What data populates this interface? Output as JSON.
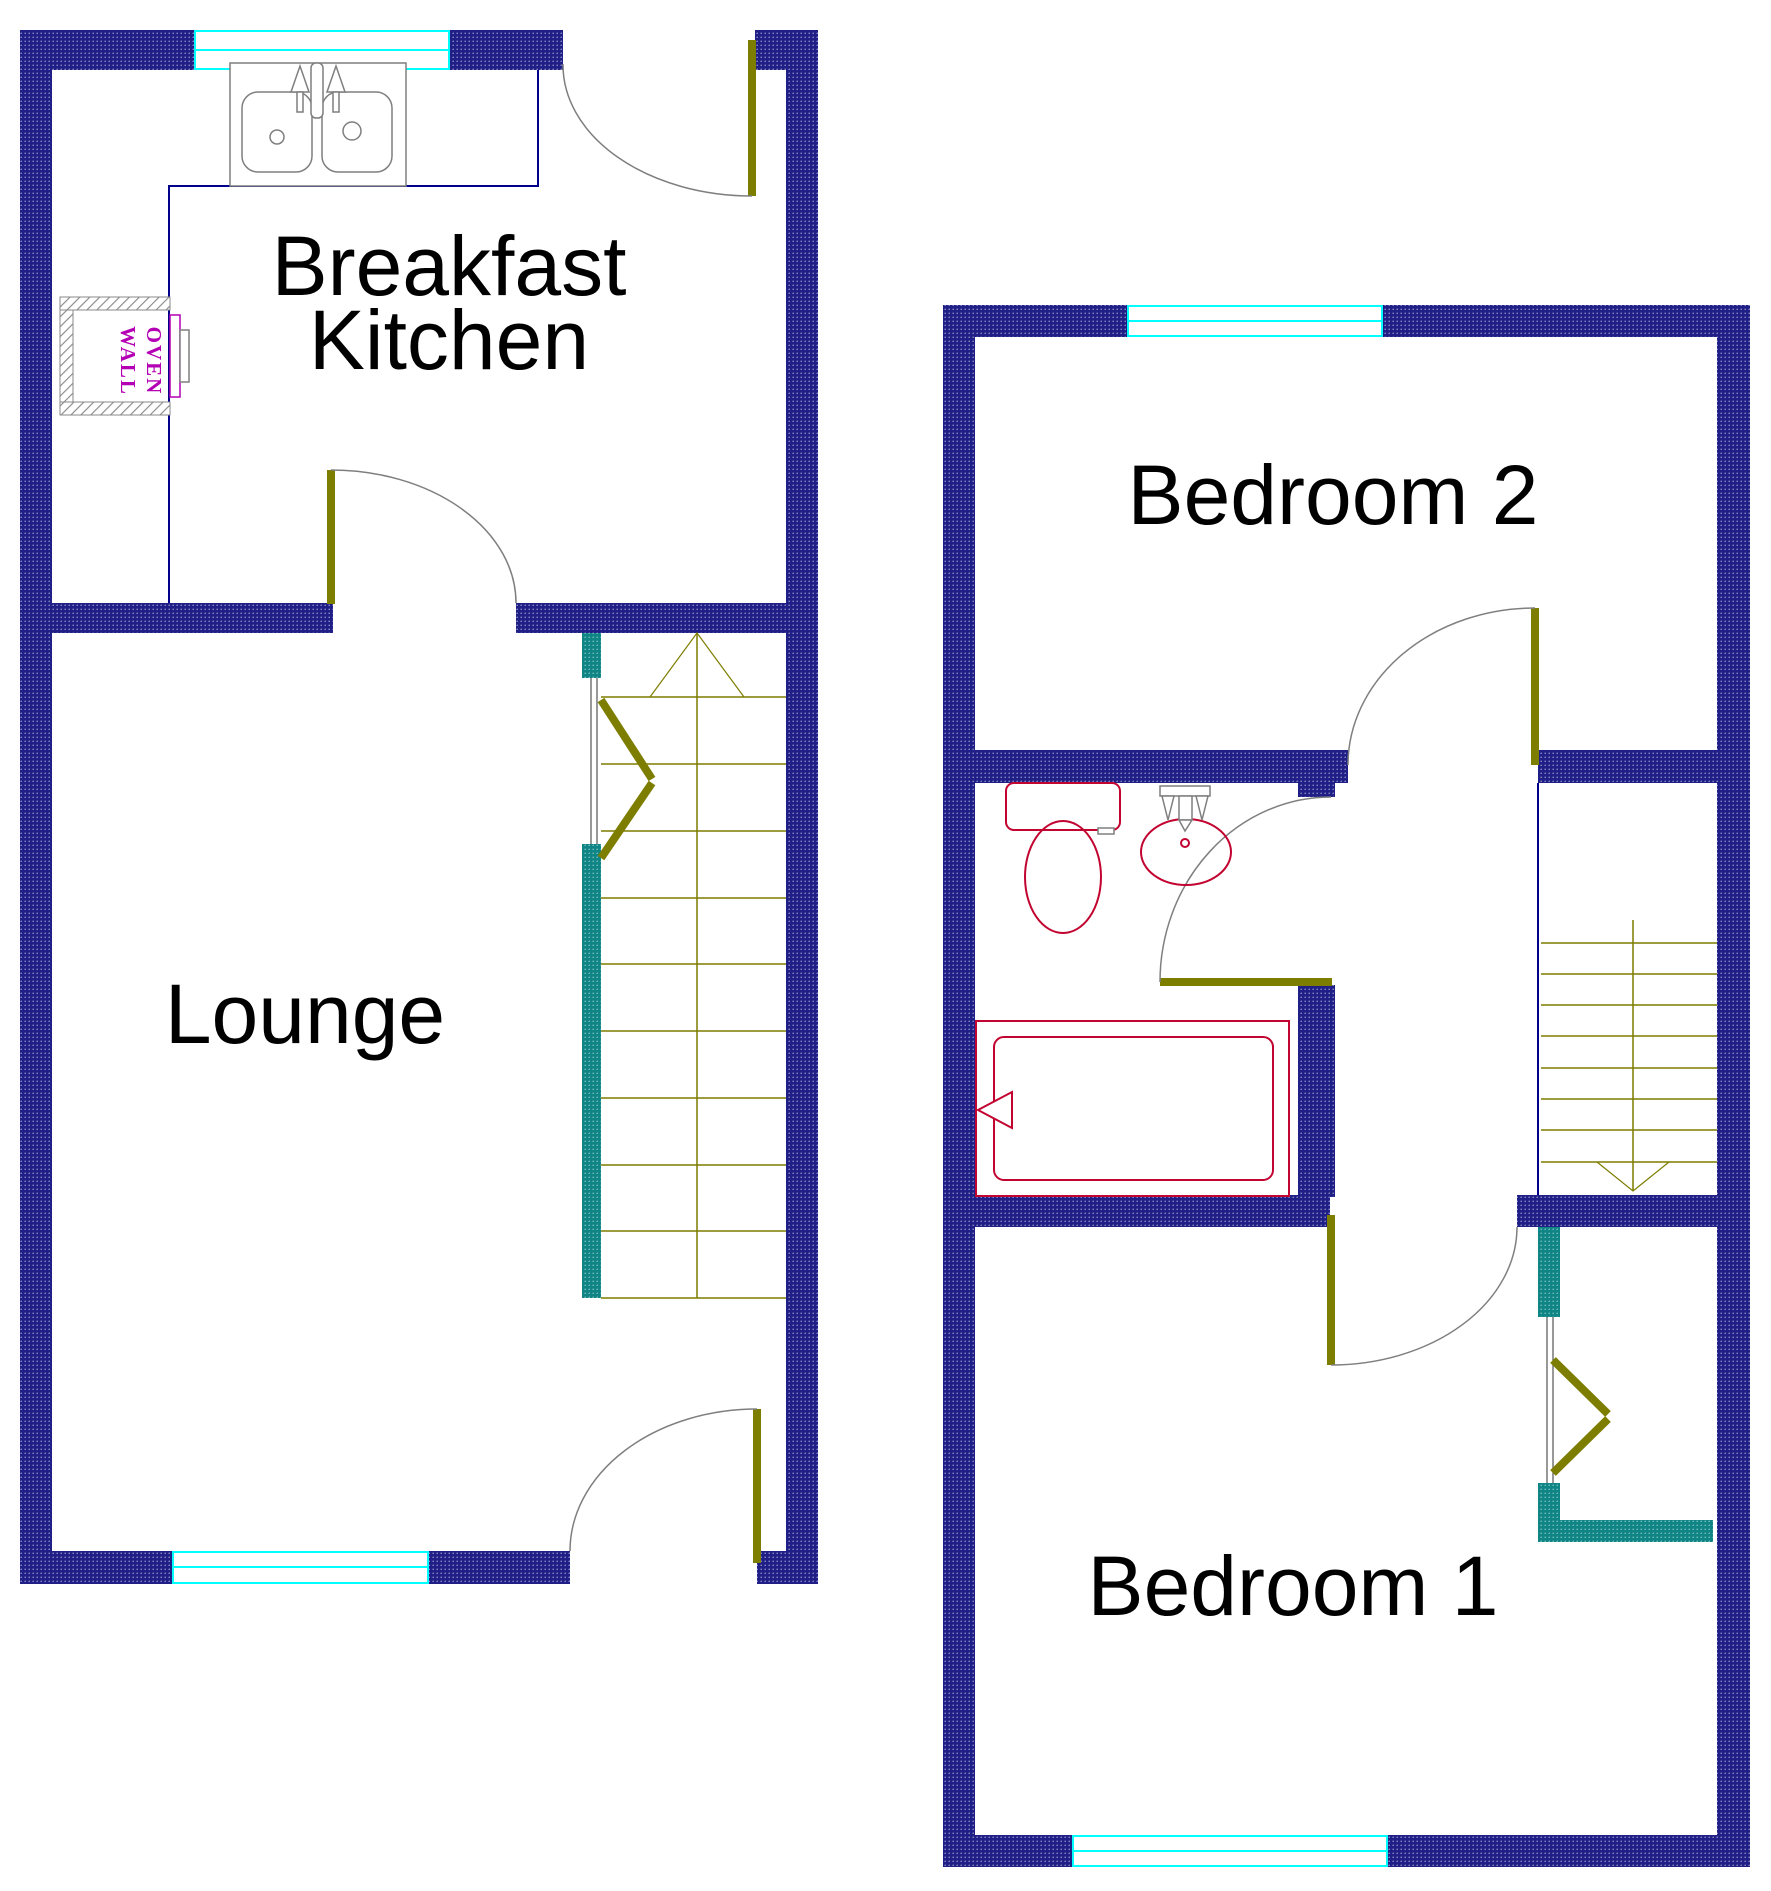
{
  "labels": {
    "kitchen_line1": "Breakfast",
    "kitchen_line2": "Kitchen",
    "lounge": "Lounge",
    "bedroom2": "Bedroom 2",
    "bedroom1": "Bedroom 1",
    "oven_line1": "OVEN",
    "oven_line2": "WALL"
  },
  "colors": {
    "wall": "#1f1f87",
    "teal": "#0f8585",
    "olive": "#7d7d00",
    "cyan": "#00ffff",
    "red": "#c20430",
    "magenta": "#b400b4",
    "navyline": "#00008b",
    "gray": "#7f7f7f",
    "hatch": "#8a8a8a",
    "textcol": "#000000"
  }
}
